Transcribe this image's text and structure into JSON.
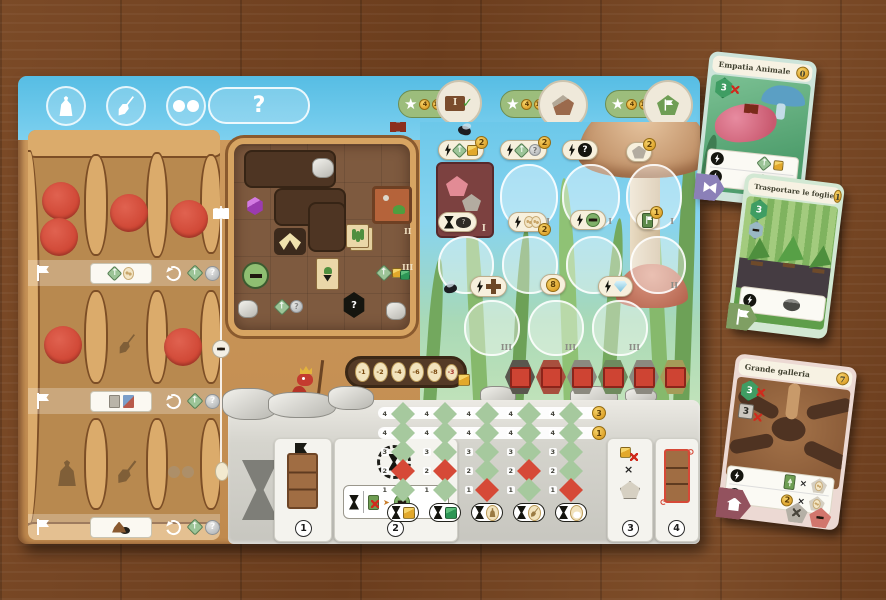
{
  "ui": {
    "question": "?",
    "multiply": "×",
    "help": "?"
  },
  "objectives": {
    "coins": [
      "4",
      "10",
      "20"
    ],
    "level_token_label": "I"
  },
  "market": {
    "levels": {
      "one": "I",
      "two": "II",
      "three": "III"
    },
    "badge_card_cube": "2",
    "badge_card_question": "2",
    "badge_pentagon": "2",
    "badge_eggs": "2",
    "badge_flag_card": "1",
    "coin_eight": "8"
  },
  "coin_track": [
    "-1",
    "-2",
    "-4",
    "-6",
    "-8",
    "-3"
  ],
  "action_panel": {
    "sections": [
      "1",
      "2",
      "3",
      "4"
    ],
    "row_labels": [
      "4",
      "4",
      "3",
      "2",
      "1"
    ],
    "score_badges": [
      "3",
      "1"
    ],
    "columns": [
      {
        "resource": "yellow-cube",
        "red_row": 3
      },
      {
        "resource": "green-cube",
        "red_row": 3
      },
      {
        "resource": "bag",
        "red_row": 4
      },
      {
        "resource": "shovel",
        "red_row": 3
      },
      {
        "resource": "binoculars",
        "red_row": 4
      }
    ]
  },
  "cards": [
    {
      "title": "Empatia Animale",
      "cost": "0",
      "ants": "3"
    },
    {
      "title": "Trasportare le foglie",
      "cost": "1",
      "ants": "3"
    },
    {
      "title": "Grande galleria",
      "cost": "7",
      "ants": "3",
      "tunnels": "3",
      "coins": "2"
    }
  ]
}
